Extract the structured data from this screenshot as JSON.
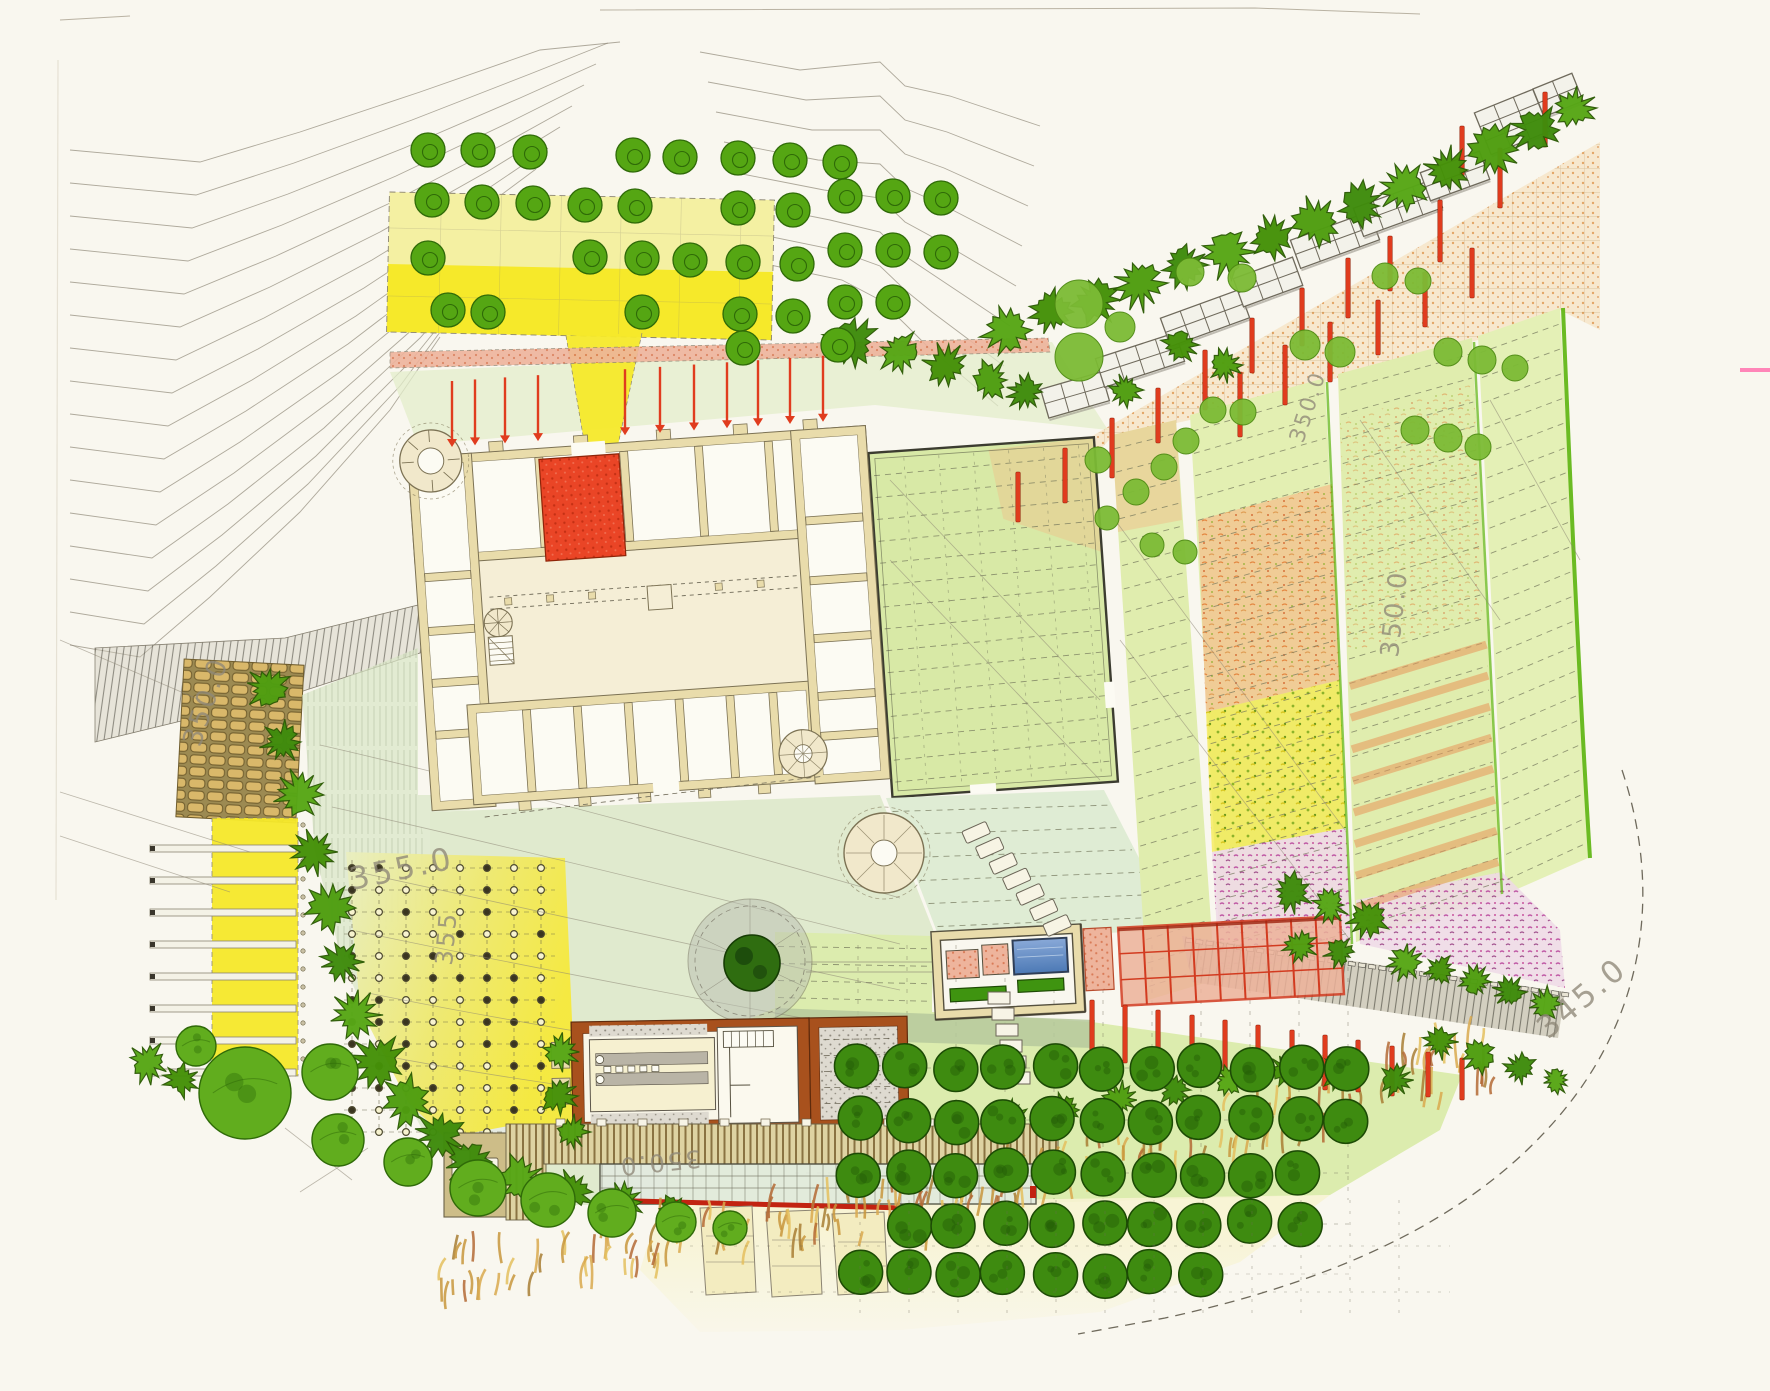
{
  "map": {
    "title": "Hand-drawn landscape masterplan (castle estate with terraced gardens, orchards and vineyards)",
    "palette": {
      "paper": "#f9f7ef",
      "contour": "#8f8878",
      "wall": "#e9dcab",
      "wallEdge": "#7c7254",
      "room": "#fcfbf3",
      "courtyard": "#f5eed6",
      "red": "#e8442a",
      "salmon": "#e79b85",
      "pool": "#5d86c0",
      "yellowBright": "#f6e92a",
      "yellowPale": "#f4f0a2",
      "fieldGreen": "#dcecae",
      "gardenGreen": "#d8e9a6",
      "orange": "#e8965a",
      "magenta": "#c8539d",
      "rust": "#a8511d",
      "deck": "#cdbd88",
      "grayHatch": "#9b958a",
      "treeGreen": "#55a613",
      "treeDark": "#3e8b10",
      "shrub": "#4a9a0e",
      "treeLight": "#7cbb35",
      "greenLine": "#5bb40c",
      "scanPink": "#ff86b8"
    },
    "labels": [
      {
        "text": "350.0",
        "transform": "translate(200,748) rotate(-72)"
      },
      {
        "text": "355.0",
        "transform": "translate(352,890) rotate(-12) scale(1.15)"
      },
      {
        "text": "355",
        "transform": "translate(452,966) rotate(-85) scale(0.9)"
      },
      {
        "text": "350.0",
        "transform": "translate(1303,444) rotate(-72) scale(0.8)"
      },
      {
        "text": "350.0",
        "transform": "translate(1398,658) rotate(-84) scale(0.95)"
      },
      {
        "text": "345.0",
        "transform": "translate(1548,1040) rotate(-40) scale(1.15)"
      },
      {
        "text": "350.0",
        "transform": "translate(700,1150) rotate(174) scale(0.9)"
      }
    ],
    "trees": {
      "ringed": [
        [
          428,
          150
        ],
        [
          478,
          150
        ],
        [
          530,
          152
        ],
        [
          633,
          155
        ],
        [
          680,
          157
        ],
        [
          738,
          158
        ],
        [
          790,
          160
        ],
        [
          840,
          162
        ],
        [
          432,
          200
        ],
        [
          482,
          202
        ],
        [
          533,
          203
        ],
        [
          585,
          205
        ],
        [
          635,
          206
        ],
        [
          738,
          208
        ],
        [
          793,
          210
        ],
        [
          428,
          258
        ],
        [
          590,
          257
        ],
        [
          642,
          258
        ],
        [
          690,
          260
        ],
        [
          743,
          262
        ],
        [
          797,
          264
        ],
        [
          448,
          310
        ],
        [
          488,
          312
        ],
        [
          642,
          312
        ],
        [
          740,
          314
        ],
        [
          793,
          316
        ],
        [
          743,
          348
        ],
        [
          845,
          196
        ],
        [
          893,
          196
        ],
        [
          941,
          198
        ],
        [
          845,
          250
        ],
        [
          893,
          250
        ],
        [
          941,
          252
        ],
        [
          845,
          302
        ],
        [
          893,
          302
        ],
        [
          838,
          345
        ]
      ],
      "light": [
        [
          1079,
          304,
          24
        ],
        [
          1120,
          327,
          15
        ],
        [
          1079,
          357,
          24
        ],
        [
          1190,
          272,
          14
        ],
        [
          1242,
          278,
          14
        ],
        [
          1385,
          276,
          13
        ],
        [
          1418,
          281,
          13
        ],
        [
          1448,
          352,
          14
        ],
        [
          1482,
          360,
          14
        ],
        [
          1515,
          368,
          13
        ],
        [
          1305,
          345,
          15
        ],
        [
          1340,
          352,
          15
        ],
        [
          1243,
          412,
          13
        ],
        [
          1213,
          410,
          13
        ],
        [
          1186,
          441,
          13
        ],
        [
          1164,
          467,
          13
        ],
        [
          1136,
          492,
          13
        ],
        [
          1107,
          518,
          12
        ],
        [
          1415,
          430,
          14
        ],
        [
          1448,
          438,
          14
        ],
        [
          1478,
          447,
          13
        ],
        [
          1098,
          460,
          13
        ],
        [
          1152,
          545,
          12
        ],
        [
          1185,
          552,
          12
        ]
      ],
      "big": [
        [
          245,
          1093,
          46
        ],
        [
          330,
          1072,
          28
        ],
        [
          338,
          1140,
          26
        ],
        [
          408,
          1162,
          24
        ],
        [
          478,
          1188,
          28
        ],
        [
          548,
          1200,
          27
        ],
        [
          612,
          1213,
          24
        ],
        [
          676,
          1222,
          20
        ],
        [
          196,
          1046,
          20
        ],
        [
          730,
          1228,
          17
        ]
      ]
    },
    "orchard": {
      "step": 49,
      "radius": 22,
      "rows": [
        {
          "y": 1068,
          "x0": 858,
          "n": 11
        },
        {
          "y": 1120,
          "x0": 858,
          "n": 11
        },
        {
          "y": 1173,
          "x0": 858,
          "n": 10
        },
        {
          "y": 1224,
          "x0": 907,
          "n": 9
        },
        {
          "y": 1274,
          "x0": 858,
          "n": 8
        }
      ]
    },
    "vineyard": {
      "x0": 352,
      "y0": 868,
      "dx": 27,
      "dy": 22,
      "cols": 8,
      "rows": 13
    },
    "arrows": {
      "xs": [
        452,
        475,
        505,
        538,
        625,
        660,
        694,
        727,
        758,
        790,
        823
      ],
      "wallY": 447,
      "slope": 0.068,
      "len": 66
    },
    "posts": [
      [
        1545,
        92,
        55
      ],
      [
        1500,
        148,
        60
      ],
      [
        1462,
        126,
        50
      ],
      [
        1440,
        200,
        62
      ],
      [
        1390,
        236,
        55
      ],
      [
        1348,
        258,
        60
      ],
      [
        1302,
        288,
        58
      ],
      [
        1252,
        318,
        55
      ],
      [
        1205,
        350,
        60
      ],
      [
        1158,
        388,
        55
      ],
      [
        1112,
        418,
        60
      ],
      [
        1065,
        448,
        55
      ],
      [
        1018,
        472,
        50
      ],
      [
        1240,
        372,
        65
      ],
      [
        1285,
        345,
        60
      ],
      [
        1330,
        322,
        60
      ],
      [
        1378,
        300,
        55
      ],
      [
        1425,
        272,
        55
      ],
      [
        1472,
        248,
        50
      ],
      [
        1092,
        1000,
        55
      ],
      [
        1125,
        1005,
        58
      ],
      [
        1158,
        1010,
        58
      ],
      [
        1192,
        1015,
        58
      ],
      [
        1225,
        1020,
        58
      ],
      [
        1258,
        1025,
        58
      ],
      [
        1292,
        1030,
        55
      ],
      [
        1325,
        1035,
        55
      ],
      [
        1358,
        1040,
        52
      ],
      [
        1392,
        1046,
        50
      ],
      [
        1428,
        1052,
        45
      ],
      [
        1462,
        1058,
        42
      ]
    ],
    "pergolaBlocks": [
      [
        1075,
        395,
        -16,
        3,
        2
      ],
      [
        1140,
        360,
        -18,
        4,
        2
      ],
      [
        1205,
        318,
        -20,
        4,
        2
      ],
      [
        1268,
        282,
        -20,
        3,
        2
      ],
      [
        1335,
        240,
        -20,
        4,
        2
      ],
      [
        1398,
        208,
        -20,
        4,
        2
      ],
      [
        1455,
        176,
        -20,
        3,
        2
      ],
      [
        1512,
        122,
        -22,
        3,
        3
      ],
      [
        1558,
        95,
        -22,
        2,
        2
      ]
    ],
    "shrubChains": {
      "west": [
        [
          268,
          688,
          22
        ],
        [
          282,
          742,
          20
        ],
        [
          300,
          795,
          24
        ],
        [
          315,
          852,
          22
        ],
        [
          330,
          908,
          24
        ],
        [
          342,
          962,
          20
        ],
        [
          355,
          1015,
          24
        ],
        [
          378,
          1062,
          26
        ],
        [
          408,
          1102,
          26
        ],
        [
          440,
          1135,
          24
        ]
      ],
      "south": [
        [
          470,
          1162,
          26
        ],
        [
          520,
          1180,
          24
        ],
        [
          572,
          1192,
          22
        ],
        [
          622,
          1202,
          20
        ],
        [
          672,
          1212,
          18
        ],
        [
          560,
          1052,
          18
        ],
        [
          558,
          1096,
          18
        ],
        [
          572,
          1132,
          16
        ]
      ],
      "castleNorth": [
        [
          852,
          342,
          26
        ],
        [
          900,
          352,
          22
        ],
        [
          946,
          366,
          22
        ],
        [
          990,
          380,
          20
        ],
        [
          1026,
          392,
          18
        ]
      ],
      "terrace": [
        [
          1008,
          330,
          26
        ],
        [
          1052,
          312,
          22
        ],
        [
          1096,
          300,
          24
        ],
        [
          1140,
          283,
          26
        ],
        [
          1184,
          265,
          22
        ],
        [
          1228,
          252,
          26
        ],
        [
          1272,
          238,
          22
        ],
        [
          1316,
          222,
          26
        ],
        [
          1360,
          206,
          24
        ],
        [
          1404,
          188,
          26
        ],
        [
          1448,
          170,
          22
        ],
        [
          1492,
          150,
          28
        ],
        [
          1536,
          130,
          24
        ],
        [
          1574,
          108,
          22
        ],
        [
          1180,
          345,
          18
        ],
        [
          1225,
          365,
          16
        ],
        [
          1125,
          390,
          16
        ]
      ],
      "southeast": [
        [
          1292,
          893,
          20
        ],
        [
          1330,
          905,
          18
        ],
        [
          1368,
          918,
          20
        ],
        [
          1300,
          946,
          16
        ],
        [
          1340,
          952,
          16
        ],
        [
          1405,
          962,
          18
        ],
        [
          1440,
          970,
          16
        ],
        [
          1475,
          982,
          16
        ],
        [
          1510,
          992,
          16
        ],
        [
          1545,
          1004,
          16
        ],
        [
          1440,
          1042,
          16
        ],
        [
          1480,
          1055,
          18
        ],
        [
          1520,
          1068,
          16
        ],
        [
          1556,
          1080,
          14
        ]
      ],
      "orchardSouth": [
        [
          1010,
          1118,
          18
        ],
        [
          1065,
          1110,
          16
        ],
        [
          1120,
          1100,
          18
        ],
        [
          1175,
          1090,
          16
        ],
        [
          1230,
          1080,
          16
        ],
        [
          1285,
          1070,
          16
        ],
        [
          1340,
          1072,
          18
        ],
        [
          1395,
          1080,
          16
        ]
      ],
      "leftEdge": [
        [
          148,
          1062,
          20
        ],
        [
          182,
          1080,
          17
        ]
      ]
    },
    "tufts": [
      {
        "x1": 430,
        "y1": 1288,
        "x2": 960,
        "y2": 1206,
        "w": 26,
        "n": 90
      },
      {
        "x1": 905,
        "y1": 1228,
        "x2": 1505,
        "y2": 1062,
        "w": 30,
        "n": 110
      }
    ],
    "terraceBars": {
      "x": 150,
      "w": 146,
      "y0": 845,
      "dy": 32,
      "n": 8
    },
    "contours": {
      "nwCount": 16,
      "neCount": 8
    }
  }
}
